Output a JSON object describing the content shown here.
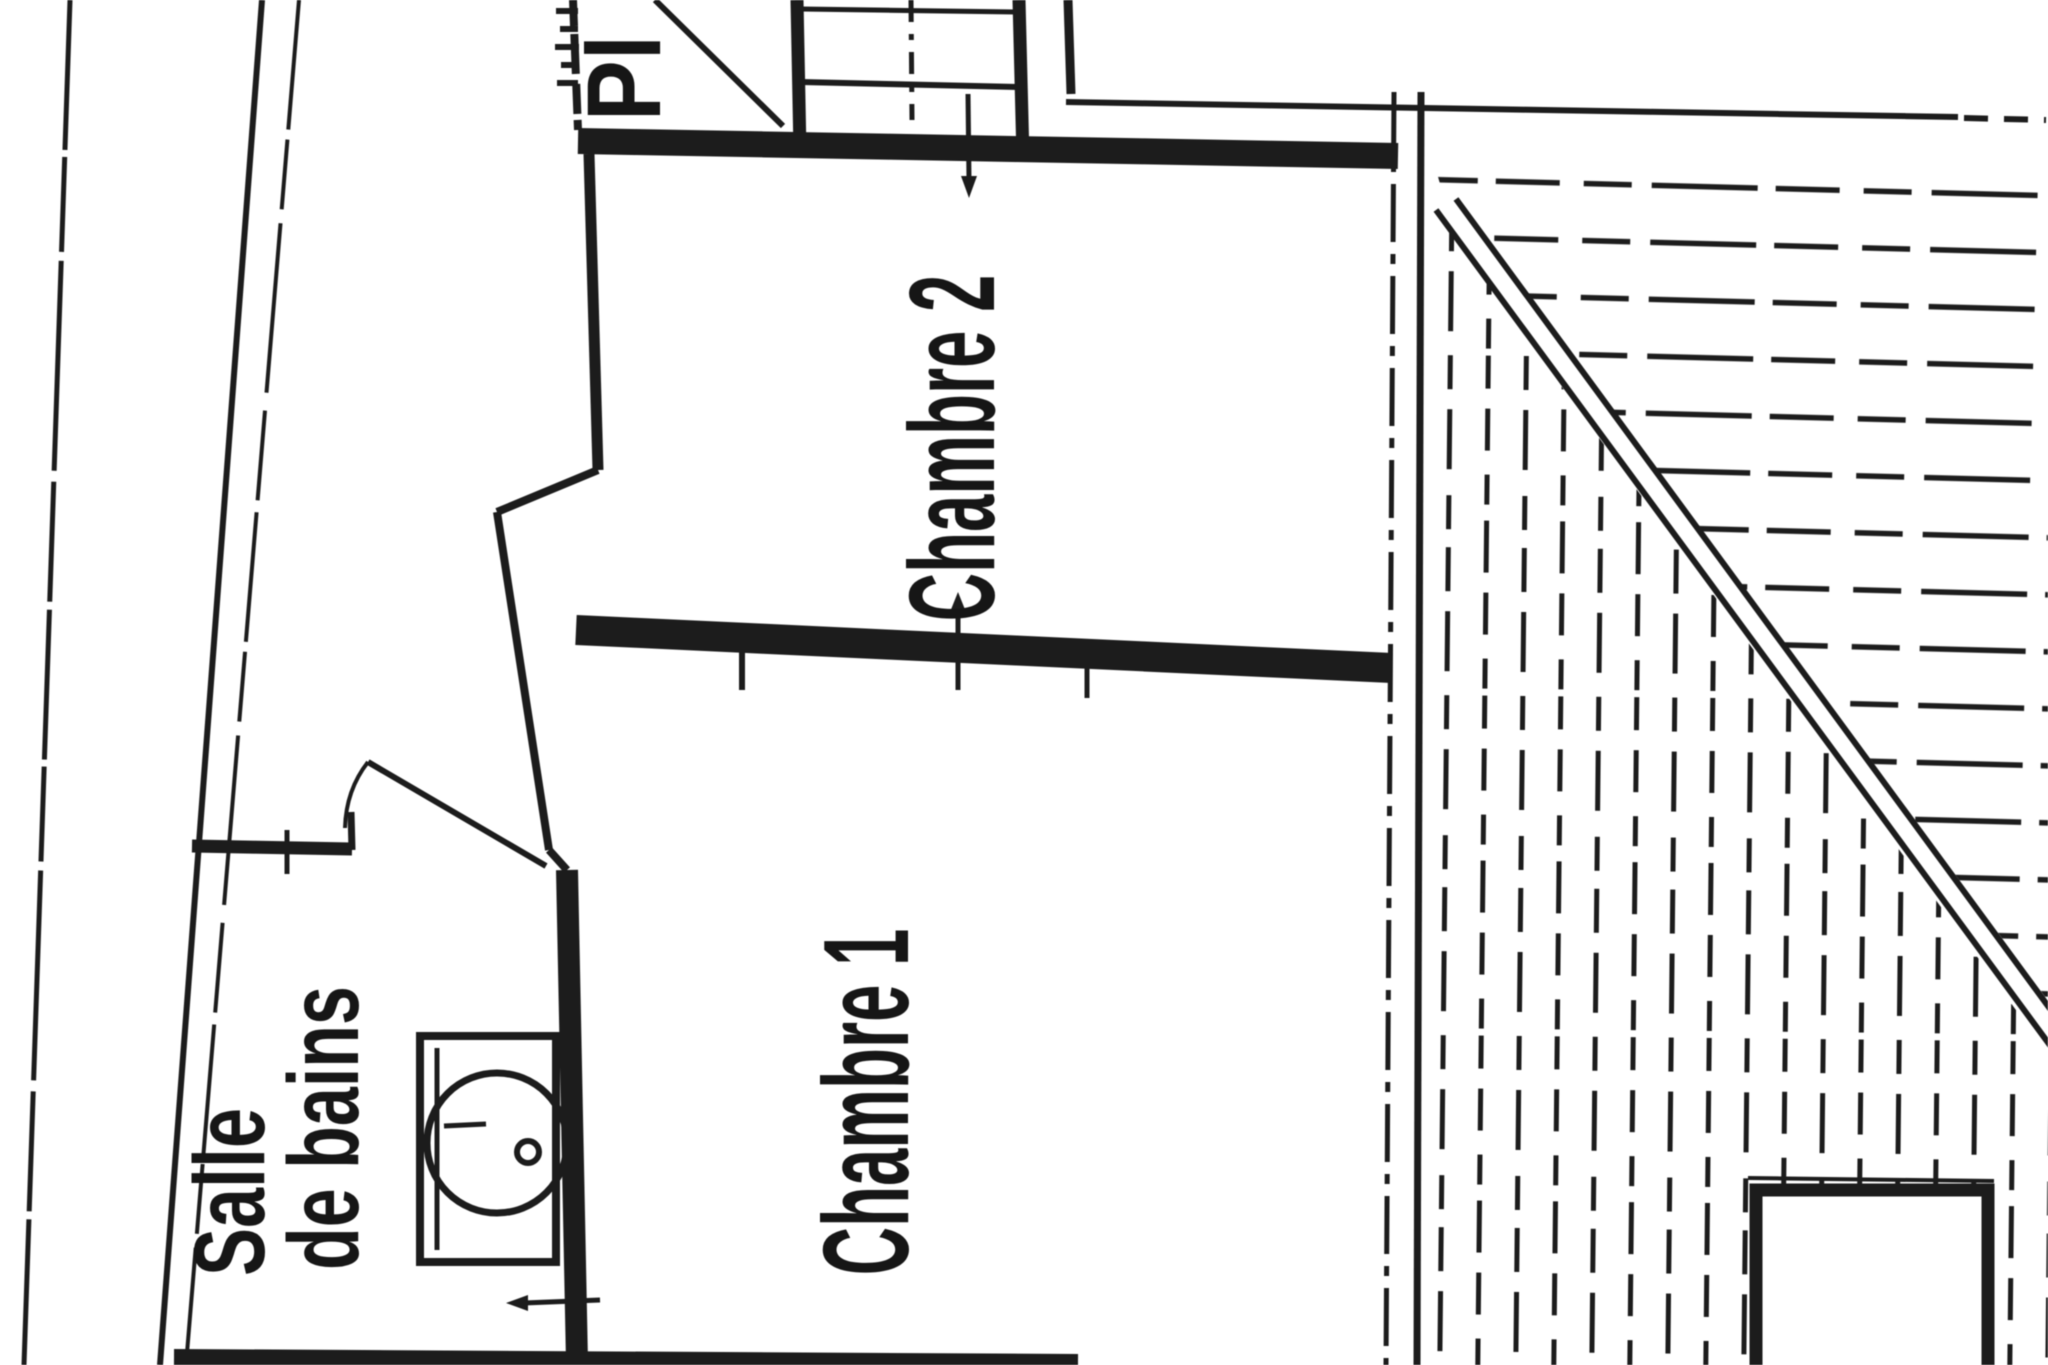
{
  "plan": {
    "labels": {
      "closet": "Pl",
      "bedroom2": "Chambre 2",
      "bedroom1": "Chambre 1",
      "bathroom_line1": "Salle",
      "bathroom_line2": "de bains"
    },
    "colors": {
      "ink": "#1c1c1c",
      "paper": "#ffffff"
    }
  }
}
